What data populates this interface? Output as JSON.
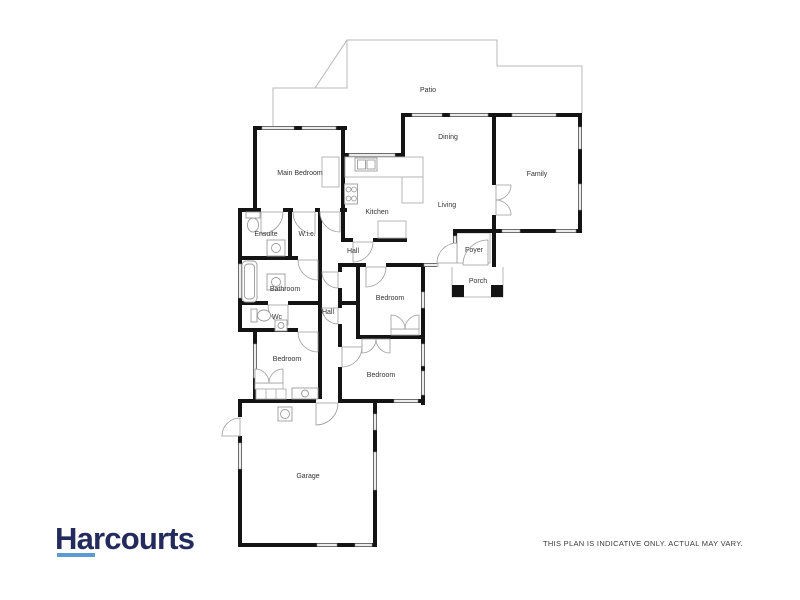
{
  "branding": {
    "logo_text": "Harcourts"
  },
  "disclaimer_text": "THIS PLAN IS INDICATIVE ONLY. ACTUAL MAY VARY.",
  "colors": {
    "background": "#ffffff",
    "wall": "#141414",
    "window_fill": "#ececec",
    "window_stroke": "#8c8c8c",
    "fixture": "#9b9b9b",
    "counter": "#b0b0b0",
    "patio_line": "#b8b8b8",
    "label": "#333333",
    "logo_navy": "#232b5d",
    "logo_blue": "#5b9bd3",
    "disclaimer": "#3a3a3a"
  },
  "rooms": {
    "patio": "Patio",
    "dining": "Dining",
    "family": "Family",
    "main_bedroom": "Main Bedroom",
    "kitchen": "Kitchen",
    "living": "Living",
    "hall_upper": "Hall",
    "ensuite": "Ensuite",
    "wic": "W.i.c.",
    "foyer": "Foyer",
    "porch": "Porch",
    "bathroom": "Bathroom",
    "hall_lower": "Hall",
    "wc": "Wc",
    "bedroom_mid": "Bedroom",
    "bedroom_left": "Bedroom",
    "bedroom_bottom": "Bedroom",
    "garage": "Garage"
  }
}
